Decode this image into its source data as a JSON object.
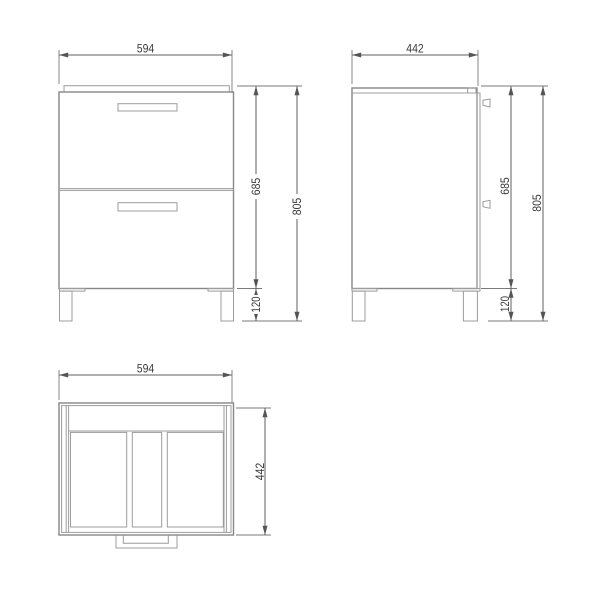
{
  "views": {
    "front": {
      "name": "front-view",
      "width_mm": "594",
      "carcass_height_mm": "685",
      "overall_height_mm": "805",
      "plinth_height_mm": "120"
    },
    "side": {
      "name": "side-view",
      "depth_mm": "442",
      "carcass_height_mm": "685",
      "overall_height_mm": "805",
      "plinth_height_mm": "120"
    },
    "top": {
      "name": "top-view",
      "width_mm": "594",
      "depth_mm": "442"
    }
  },
  "colors": {
    "background": "#ffffff",
    "object_line": "#9c9c9c",
    "dimension_line": "#5f5f5f",
    "label_text": "#3a3a3a"
  }
}
